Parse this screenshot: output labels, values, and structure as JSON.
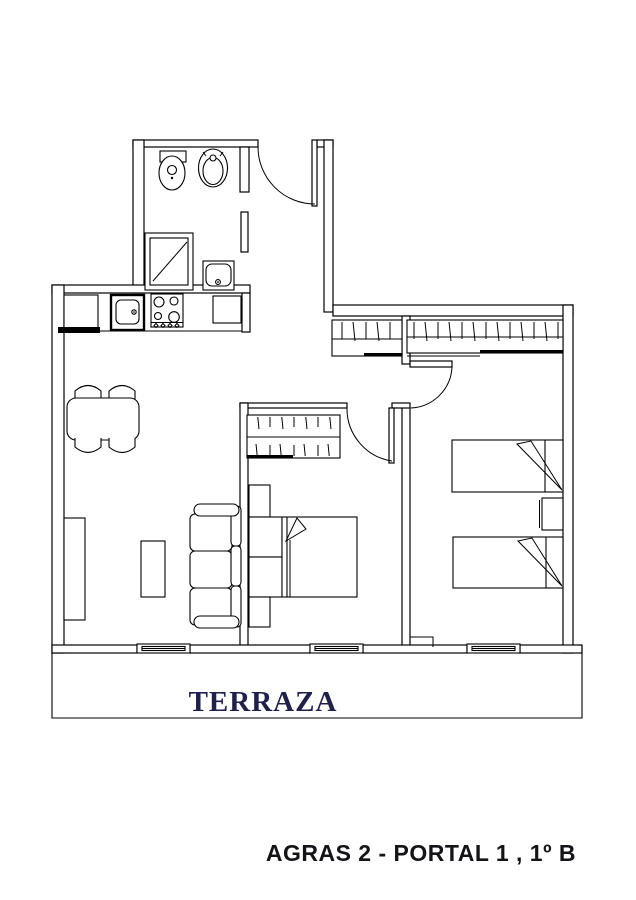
{
  "plan": {
    "terrace_label": "TERRAZA",
    "title": "AGRAS 2 - PORTAL 1 , 1º B"
  },
  "colors": {
    "wall_line": "#000000",
    "terrace_label": "#20204e",
    "title": "#131318",
    "background": "#ffffff"
  },
  "fixtures": [
    "bidet",
    "toilet",
    "shower-tray",
    "bathroom-washbasin",
    "fridge-cabinet",
    "kitchen-sink",
    "stove-4-burners",
    "oven",
    "dining-table",
    "chair",
    "chair",
    "chair",
    "chair",
    "sideboard",
    "coffee-table",
    "sofa-3-seats",
    "corridor-wardrobe",
    "bedroom-wardrobe",
    "bedroom-wardrobe",
    "double-bed",
    "nightstand",
    "nightstand",
    "headboard-unit",
    "single-bed",
    "single-bed",
    "nightstand",
    "terrace-window",
    "terrace-window",
    "terrace-window",
    "entry-door",
    "bathroom-door",
    "bedroom-door",
    "bedroom-door"
  ]
}
